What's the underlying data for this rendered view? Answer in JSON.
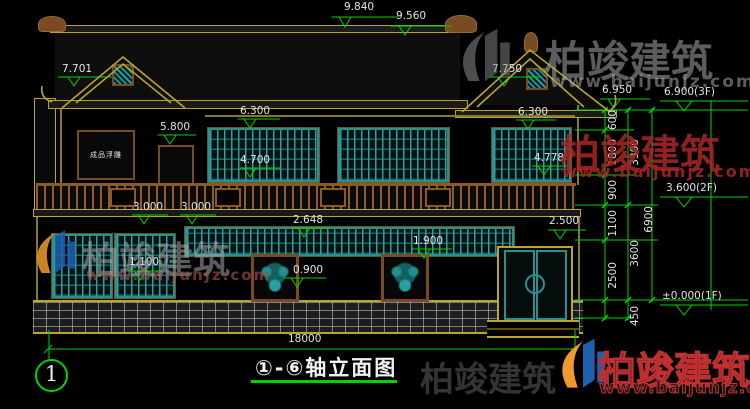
{
  "title_block": {
    "title": "①-⑥轴立面图",
    "axis_bubble": "1"
  },
  "panel_text": "成品浮雕",
  "watermark": {
    "brand": "柏竣建筑",
    "url": "www.baijunjz.com"
  },
  "colors": {
    "background": "#000000",
    "dimension_green": "#00d400",
    "outline_olive": "#b8a42e",
    "lattice_teal": "#2a9d9d",
    "wood_brown": "#8a5a2a",
    "watermark_red": "#b03030",
    "logo_blue": "#1e5fae",
    "logo_orange": "#f09a2e",
    "text_white": "#e8e8e8"
  },
  "dimensions": [
    {
      "text": "9.840",
      "x": 344,
      "y": 2
    },
    {
      "text": "9.560",
      "x": 396,
      "y": 11
    },
    {
      "text": "7.701",
      "x": 62,
      "y": 64
    },
    {
      "text": "7.750",
      "x": 492,
      "y": 64
    },
    {
      "text": "6.950",
      "x": 602,
      "y": 85
    },
    {
      "text": "6.900(3F)",
      "x": 664,
      "y": 87
    },
    {
      "text": "6.300",
      "x": 240,
      "y": 106
    },
    {
      "text": "6.300",
      "x": 518,
      "y": 107
    },
    {
      "text": "5.800",
      "x": 160,
      "y": 122
    },
    {
      "text": "4.700",
      "x": 240,
      "y": 155
    },
    {
      "text": "4.778",
      "x": 534,
      "y": 153
    },
    {
      "text": "3.600(2F)",
      "x": 666,
      "y": 183
    },
    {
      "text": "3.000",
      "x": 133,
      "y": 202
    },
    {
      "text": "3.000",
      "x": 181,
      "y": 202
    },
    {
      "text": "2.648",
      "x": 293,
      "y": 215
    },
    {
      "text": "2.500",
      "x": 549,
      "y": 216
    },
    {
      "text": "1.900",
      "x": 413,
      "y": 236
    },
    {
      "text": "1.100",
      "x": 129,
      "y": 257
    },
    {
      "text": "0.900",
      "x": 293,
      "y": 265
    },
    {
      "text": "±0.000(1F)",
      "x": 662,
      "y": 291
    },
    {
      "text": "18000",
      "x": 288,
      "y": 334
    },
    {
      "text": "600",
      "x": 608,
      "y": 110,
      "rot": true
    },
    {
      "text": "1800",
      "x": 608,
      "y": 139,
      "rot": true
    },
    {
      "text": "3300",
      "x": 630,
      "y": 139,
      "rot": true
    },
    {
      "text": "900",
      "x": 608,
      "y": 180,
      "rot": true
    },
    {
      "text": "1100",
      "x": 608,
      "y": 210,
      "rot": true
    },
    {
      "text": "6900",
      "x": 644,
      "y": 206,
      "rot": true
    },
    {
      "text": "3600",
      "x": 630,
      "y": 240,
      "rot": true
    },
    {
      "text": "2500",
      "x": 608,
      "y": 262,
      "rot": true
    },
    {
      "text": "450",
      "x": 630,
      "y": 306,
      "rot": true
    }
  ]
}
